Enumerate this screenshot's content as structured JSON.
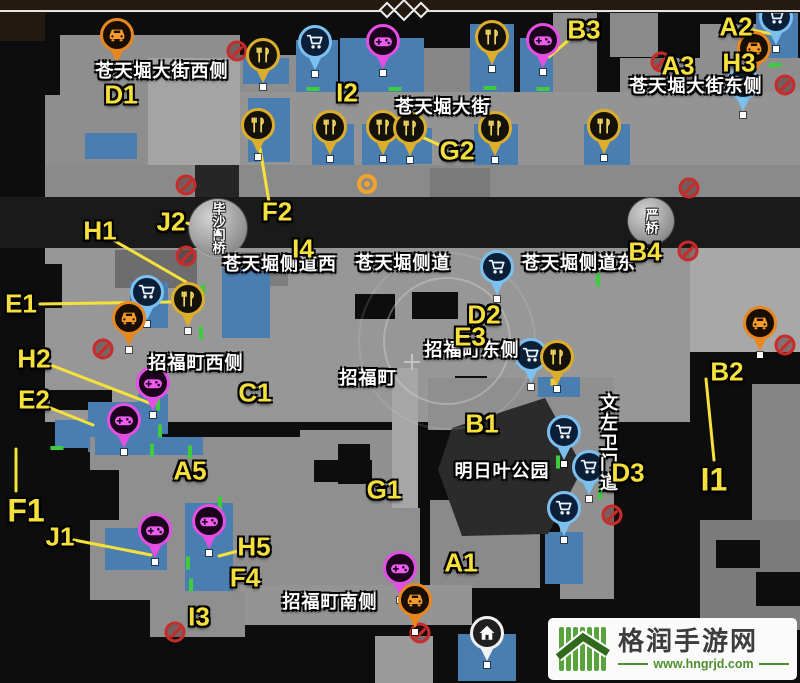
{
  "watermark": {
    "site_name": "格润手游网",
    "site_url": "www.hngrjd.com"
  },
  "colors": {
    "label_yellow": "#f6e13c",
    "street_white": "#ffffff",
    "building_gray": "#979797",
    "shop_blue": "#4a7db0",
    "road_dark": "#1a1a1a",
    "no_entry_red": "#c92a2a",
    "door_green": "#3ecb3e",
    "watermark_green": "#4c8f2b",
    "watermark_text": "#3d3d3d"
  },
  "map": {
    "letter_labels": [
      {
        "id": "D1",
        "x": 121,
        "y": 95
      },
      {
        "id": "I2",
        "x": 347,
        "y": 93
      },
      {
        "id": "G2",
        "x": 457,
        "y": 151
      },
      {
        "id": "B3",
        "x": 584,
        "y": 30
      },
      {
        "id": "A2",
        "x": 736,
        "y": 27
      },
      {
        "id": "A3",
        "x": 678,
        "y": 66
      },
      {
        "id": "H3",
        "x": 739,
        "y": 63
      },
      {
        "id": "B4",
        "x": 645,
        "y": 252
      },
      {
        "id": "F2",
        "x": 277,
        "y": 212
      },
      {
        "id": "J2",
        "x": 171,
        "y": 222
      },
      {
        "id": "H1",
        "x": 100,
        "y": 231
      },
      {
        "id": "I4",
        "x": 303,
        "y": 249
      },
      {
        "id": "E1",
        "x": 21,
        "y": 304
      },
      {
        "id": "H2",
        "x": 34,
        "y": 359
      },
      {
        "id": "E2",
        "x": 34,
        "y": 400
      },
      {
        "id": "C1",
        "x": 255,
        "y": 393
      },
      {
        "id": "A5",
        "x": 190,
        "y": 471
      },
      {
        "id": "F1",
        "x": 26,
        "y": 511,
        "size": 32
      },
      {
        "id": "J1",
        "x": 60,
        "y": 537
      },
      {
        "id": "H5",
        "x": 254,
        "y": 547
      },
      {
        "id": "F4",
        "x": 245,
        "y": 578
      },
      {
        "id": "I3",
        "x": 199,
        "y": 617
      },
      {
        "id": "G1",
        "x": 384,
        "y": 490
      },
      {
        "id": "B1",
        "x": 482,
        "y": 424
      },
      {
        "id": "A1",
        "x": 461,
        "y": 563
      },
      {
        "id": "D2",
        "x": 484,
        "y": 315
      },
      {
        "id": "E3",
        "x": 470,
        "y": 337
      },
      {
        "id": "D3",
        "x": 628,
        "y": 473
      },
      {
        "id": "B2",
        "x": 727,
        "y": 372
      },
      {
        "id": "I1",
        "x": 714,
        "y": 480,
        "size": 32
      }
    ],
    "leader_lines": [
      [
        444,
        147,
        413,
        133
      ],
      [
        571,
        38,
        549,
        57
      ],
      [
        752,
        30,
        772,
        34
      ],
      [
        269,
        202,
        260,
        148
      ],
      [
        187,
        223,
        202,
        229
      ],
      [
        113,
        240,
        186,
        282
      ],
      [
        40,
        304,
        171,
        302
      ],
      [
        48,
        364,
        152,
        404
      ],
      [
        48,
        407,
        93,
        425
      ],
      [
        74,
        540,
        151,
        555
      ],
      [
        238,
        551,
        219,
        556
      ],
      [
        706,
        379,
        714,
        460
      ],
      [
        16,
        449,
        16,
        491
      ]
    ],
    "streets": [
      {
        "text": "苍天堀大街西侧",
        "x": 162,
        "y": 70
      },
      {
        "text": "苍天堀大街",
        "x": 443,
        "y": 106
      },
      {
        "text": "苍天堀大街东侧",
        "x": 696,
        "y": 85
      },
      {
        "text": "苍天堀侧道西",
        "x": 280,
        "y": 263
      },
      {
        "text": "苍天堀侧道",
        "x": 403,
        "y": 262
      },
      {
        "text": "苍天堀侧道东",
        "x": 579,
        "y": 262
      },
      {
        "text": "招福町西侧",
        "x": 196,
        "y": 362
      },
      {
        "text": "招福町",
        "x": 368,
        "y": 377
      },
      {
        "text": "招福町东侧",
        "x": 472,
        "y": 349
      },
      {
        "text": "明日叶公园",
        "x": 502,
        "y": 470
      },
      {
        "text": "招福町南侧",
        "x": 330,
        "y": 601
      },
      {
        "text": "文左卫门道",
        "x": 608,
        "y": 443,
        "vertical": true
      }
    ],
    "bridges": [
      {
        "text": "毕沙门桥",
        "x": 218,
        "y": 228,
        "d": 58,
        "arrow": true
      },
      {
        "text": "严桥",
        "x": 651,
        "y": 221,
        "d": 46
      }
    ],
    "pins": [
      {
        "type": "taxi",
        "x": 117,
        "y": 35
      },
      {
        "type": "cart",
        "x": 315,
        "y": 42
      },
      {
        "type": "game",
        "x": 383,
        "y": 41
      },
      {
        "type": "food",
        "x": 492,
        "y": 37
      },
      {
        "type": "game",
        "x": 543,
        "y": 40
      },
      {
        "type": "cart",
        "x": 776,
        "y": 17
      },
      {
        "type": "taxi",
        "x": 754,
        "y": 48
      },
      {
        "type": "cart",
        "x": 743,
        "y": 83
      },
      {
        "type": "food",
        "x": 263,
        "y": 55
      },
      {
        "type": "food",
        "x": 258,
        "y": 125
      },
      {
        "type": "food",
        "x": 330,
        "y": 127
      },
      {
        "type": "food",
        "x": 383,
        "y": 127
      },
      {
        "type": "food",
        "x": 410,
        "y": 128
      },
      {
        "type": "food",
        "x": 495,
        "y": 128
      },
      {
        "type": "food",
        "x": 604,
        "y": 126
      },
      {
        "type": "cart",
        "x": 147,
        "y": 292
      },
      {
        "type": "food",
        "x": 188,
        "y": 299
      },
      {
        "type": "taxi",
        "x": 129,
        "y": 318
      },
      {
        "type": "cart",
        "x": 497,
        "y": 267
      },
      {
        "type": "cart",
        "x": 531,
        "y": 355
      },
      {
        "type": "food",
        "x": 557,
        "y": 357
      },
      {
        "type": "game",
        "x": 153,
        "y": 383
      },
      {
        "type": "game",
        "x": 124,
        "y": 420
      },
      {
        "type": "taxi",
        "x": 760,
        "y": 323
      },
      {
        "type": "cart",
        "x": 564,
        "y": 432
      },
      {
        "type": "cart",
        "x": 589,
        "y": 467
      },
      {
        "type": "cart",
        "x": 564,
        "y": 508
      },
      {
        "type": "game",
        "x": 155,
        "y": 530
      },
      {
        "type": "game",
        "x": 209,
        "y": 521
      },
      {
        "type": "game",
        "x": 400,
        "y": 568
      },
      {
        "type": "taxi",
        "x": 415,
        "y": 600
      },
      {
        "type": "home",
        "x": 487,
        "y": 633
      }
    ],
    "pin_styles": {
      "food": {
        "ring": "#dcae2c",
        "fill": "#15120a",
        "glyph": "#f3d563",
        "name": "restaurant-pin"
      },
      "cart": {
        "ring": "#7cc0ef",
        "fill": "#0b1f38",
        "glyph": "#eef6ff",
        "name": "shop-pin"
      },
      "game": {
        "ring": "#e24fe2",
        "fill": "#1c021c",
        "glyph": "#ee5cf0",
        "name": "arcade-pin"
      },
      "taxi": {
        "ring": "#e8871f",
        "fill": "#190e02",
        "glyph": "#f49b2b",
        "name": "taxi-pin"
      },
      "home": {
        "ring": "#f2f2f2",
        "fill": "#202020",
        "glyph": "#fafafa",
        "name": "home-pin"
      }
    },
    "no_entry": [
      [
        237,
        51
      ],
      [
        186,
        185
      ],
      [
        186,
        256
      ],
      [
        103,
        349
      ],
      [
        661,
        62
      ],
      [
        785,
        85
      ],
      [
        689,
        188
      ],
      [
        688,
        251
      ],
      [
        785,
        345
      ],
      [
        612,
        515
      ],
      [
        420,
        633
      ],
      [
        175,
        632
      ]
    ],
    "door_marks": [
      [
        313,
        89,
        "h"
      ],
      [
        395,
        89,
        "h"
      ],
      [
        490,
        88,
        "h"
      ],
      [
        543,
        89,
        "h"
      ],
      [
        775,
        65,
        "h"
      ],
      [
        57,
        448,
        "h"
      ],
      [
        203,
        291,
        "v"
      ],
      [
        201,
        333,
        "v"
      ],
      [
        598,
        280,
        "v"
      ],
      [
        158,
        404,
        "v"
      ],
      [
        160,
        431,
        "v"
      ],
      [
        190,
        452,
        "v"
      ],
      [
        152,
        450,
        "v"
      ],
      [
        188,
        563,
        "v"
      ],
      [
        191,
        585,
        "v"
      ],
      [
        600,
        493,
        "v"
      ],
      [
        558,
        462,
        "v"
      ],
      [
        220,
        503,
        "v"
      ]
    ],
    "quest_marker": {
      "x": 367,
      "y": 184
    },
    "yellow_dots": [
      [
        554,
        382
      ]
    ],
    "position_rings": {
      "cx": 447,
      "cy": 341,
      "radii": [
        63,
        88
      ]
    },
    "road_cross": {
      "x": 412,
      "y": 362
    },
    "park_polygon": "452,428 545,398 583,468 548,534 462,536 438,470",
    "blocks": [
      [
        0,
        13,
        45,
        28,
        "#221a11"
      ],
      [
        60,
        35,
        180,
        130,
        "#8e8e8e"
      ],
      [
        148,
        58,
        92,
        107,
        "#a4a4a4"
      ],
      [
        45,
        95,
        18,
        70,
        "#8e8e8e"
      ],
      [
        85,
        133,
        52,
        26,
        "#4a7db0"
      ],
      [
        240,
        55,
        72,
        40,
        "#8e8e8e"
      ],
      [
        243,
        58,
        46,
        26,
        "#4a7db0"
      ],
      [
        296,
        40,
        42,
        54,
        "#4a7db0"
      ],
      [
        340,
        38,
        84,
        58,
        "#4a7db0"
      ],
      [
        424,
        48,
        66,
        46,
        "#878787"
      ],
      [
        470,
        24,
        44,
        70,
        "#4a7db0"
      ],
      [
        520,
        38,
        50,
        56,
        "#4a7db0"
      ],
      [
        553,
        13,
        44,
        80,
        "#8e8e8e"
      ],
      [
        610,
        13,
        48,
        44,
        "#8a8a8a"
      ],
      [
        700,
        24,
        62,
        70,
        "#8e8e8e"
      ],
      [
        756,
        13,
        42,
        50,
        "#4a7db0"
      ],
      [
        766,
        62,
        34,
        30,
        "#6f6f6f"
      ],
      [
        620,
        58,
        180,
        36,
        "#8e8e8e"
      ],
      [
        240,
        92,
        560,
        76,
        "#949494"
      ],
      [
        248,
        98,
        42,
        64,
        "#4a7db0"
      ],
      [
        312,
        124,
        42,
        42,
        "#4a7db0"
      ],
      [
        362,
        124,
        48,
        42,
        "#4a7db0"
      ],
      [
        400,
        128,
        32,
        36,
        "#4a7db0"
      ],
      [
        474,
        124,
        44,
        42,
        "#4a7db0"
      ],
      [
        584,
        124,
        46,
        42,
        "#4a7db0"
      ],
      [
        45,
        165,
        755,
        33,
        "#8a8a8a"
      ],
      [
        195,
        165,
        44,
        33,
        "#262626"
      ],
      [
        430,
        168,
        60,
        30,
        "#7a7a7a"
      ],
      [
        0,
        197,
        800,
        51,
        "#1a1a1a"
      ],
      [
        45,
        248,
        660,
        174,
        "#979797"
      ],
      [
        115,
        250,
        82,
        38,
        "#6d6d6d"
      ],
      [
        230,
        252,
        58,
        34,
        "#7e7e7e"
      ],
      [
        0,
        264,
        62,
        44,
        "#0d0d0d"
      ],
      [
        355,
        294,
        40,
        25,
        "#0d0d0d"
      ],
      [
        412,
        292,
        46,
        27,
        "#0d0d0d"
      ],
      [
        50,
        390,
        62,
        20,
        "#0d0d0d"
      ],
      [
        455,
        376,
        32,
        22,
        "#0d0d0d"
      ],
      [
        130,
        282,
        38,
        46,
        "#4a7db0"
      ],
      [
        222,
        268,
        48,
        70,
        "#4a7db0"
      ],
      [
        138,
        394,
        30,
        40,
        "#4a7db0"
      ],
      [
        88,
        402,
        74,
        50,
        "#4a7db0"
      ],
      [
        55,
        420,
        50,
        28,
        "#4a7db0"
      ],
      [
        690,
        248,
        110,
        104,
        "#a8a8a8"
      ],
      [
        690,
        352,
        110,
        168,
        "#0d0d0d"
      ],
      [
        752,
        384,
        48,
        136,
        "#868686"
      ],
      [
        700,
        520,
        100,
        110,
        "#7b7b7b"
      ],
      [
        716,
        540,
        44,
        28,
        "#0d0d0d"
      ],
      [
        756,
        572,
        44,
        34,
        "#0d0d0d"
      ],
      [
        640,
        424,
        62,
        34,
        "#0d0d0d"
      ],
      [
        668,
        458,
        34,
        30,
        "#0d0d0d"
      ],
      [
        428,
        378,
        164,
        52,
        "#8f8f8f"
      ],
      [
        560,
        377,
        54,
        222,
        "#909090"
      ],
      [
        538,
        377,
        42,
        20,
        "#4a7db0"
      ],
      [
        545,
        532,
        38,
        52,
        "#4a7db0"
      ],
      [
        90,
        437,
        212,
        163,
        "#8f8f8f"
      ],
      [
        95,
        437,
        108,
        18,
        "#4a7db0"
      ],
      [
        87,
        470,
        32,
        50,
        "#0d0d0d"
      ],
      [
        105,
        528,
        62,
        42,
        "#4a7db0"
      ],
      [
        185,
        503,
        48,
        88,
        "#4a7db0"
      ],
      [
        300,
        430,
        96,
        82,
        "#909090"
      ],
      [
        392,
        368,
        26,
        144,
        "#a6a6a6"
      ],
      [
        338,
        444,
        32,
        40,
        "#0d0d0d"
      ],
      [
        314,
        460,
        58,
        22,
        "#0d0d0d"
      ],
      [
        300,
        508,
        120,
        80,
        "#8f8f8f"
      ],
      [
        430,
        500,
        110,
        88,
        "#8a8a8a"
      ],
      [
        240,
        585,
        232,
        40,
        "#949494"
      ],
      [
        150,
        592,
        95,
        45,
        "#8f8f8f"
      ],
      [
        375,
        636,
        58,
        47,
        "#9a9a9a"
      ],
      [
        458,
        634,
        58,
        47,
        "#4a7db0"
      ]
    ]
  }
}
